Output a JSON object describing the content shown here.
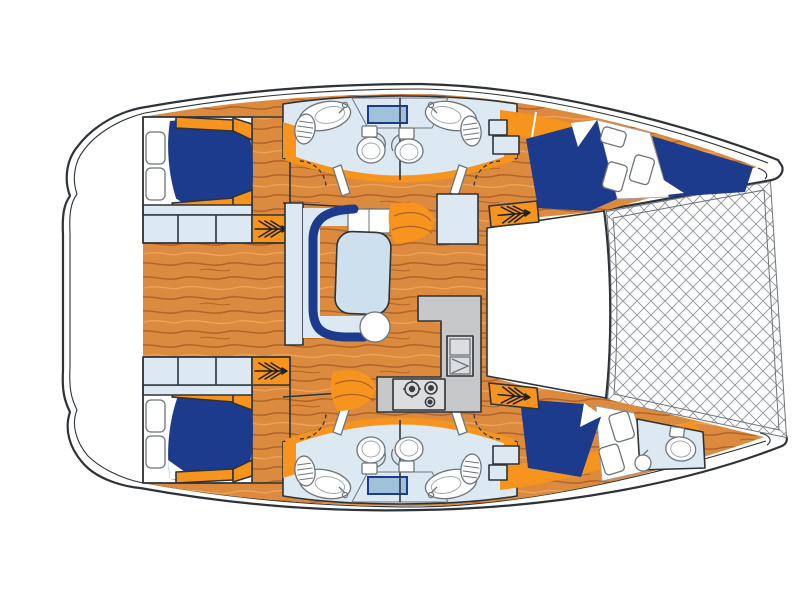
{
  "diagram": {
    "palette": {
      "outline": "#2E3338",
      "hull_white": "#FFFFFF",
      "wood_base": "#DC8B3E",
      "wood_grain": "#B2652A",
      "wood_grain_light": "#ECA259",
      "berth_navy": "#1C3B8D",
      "furniture_orange": "#F7941E",
      "fixture_blue": "#DDE9F2",
      "table_blue": "#CCE0EE",
      "glass_blue": "#C3D8E7",
      "window_blue": "#9FC2DA",
      "counter_gray": "#C6C8CA",
      "counter_gray_light": "#DBDDDF",
      "net_gray": "#8E9499",
      "burner_dark": "#3A3E42"
    },
    "features": {
      "hulls": 2,
      "double_berths": 4,
      "forepeak_berth": 1,
      "heads_toilets": 5,
      "sinks": 5,
      "galley_burners": 3,
      "companionway_steps": 4,
      "trampoline_nets": 1,
      "saloon_tables": 1
    }
  }
}
